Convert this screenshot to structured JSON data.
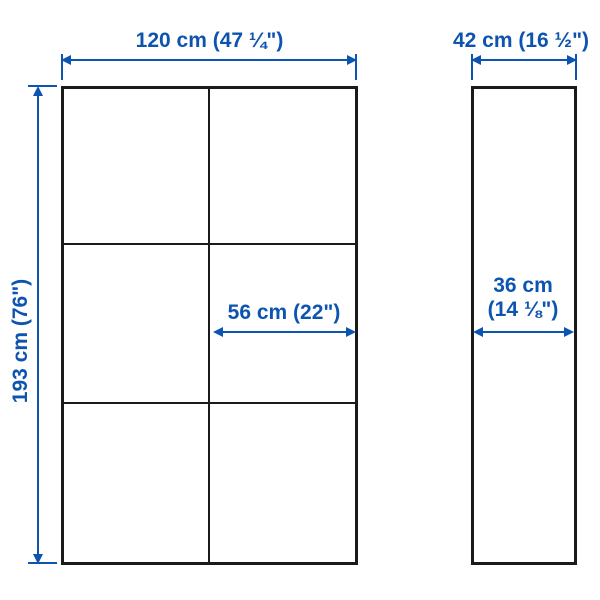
{
  "diagram": {
    "kind": "furniture-dimension-diagram",
    "colors": {
      "accent_blue": "#0d54b0",
      "outline_black": "#1a1a1a",
      "background": "#ffffff"
    },
    "front_view": {
      "grid_columns": 2,
      "grid_rows": 3
    },
    "dimensions": {
      "front_width": "120 cm (47 ¼\")",
      "side_width": "42 cm (16 ½\")",
      "front_height": "193 cm (76\")",
      "door_width": "56 cm (22\")",
      "side_depth_line1": "36 cm",
      "side_depth_line2": "(14 ⅛\")"
    }
  }
}
